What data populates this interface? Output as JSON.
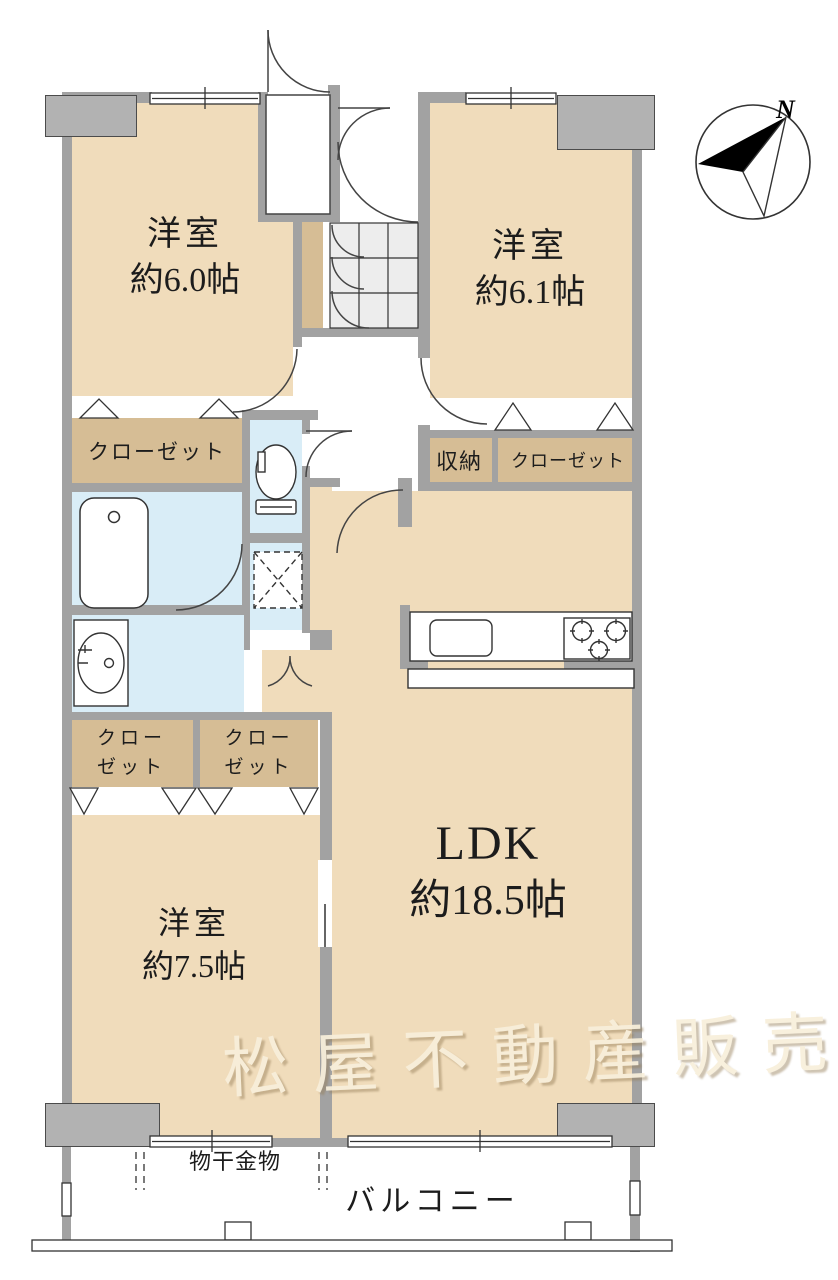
{
  "floorplan": {
    "rooms": {
      "bedroom_nw": {
        "name": "洋室",
        "size": "約6.0帖"
      },
      "bedroom_ne": {
        "name": "洋室",
        "size": "約6.1帖"
      },
      "bedroom_sw": {
        "name": "洋室",
        "size": "約7.5帖"
      },
      "ldk": {
        "name": "LDK",
        "size": "約18.5帖"
      }
    },
    "storage": {
      "closet_nw": "クローゼット",
      "shuno": "収納",
      "closet_ne": "クローゼット",
      "closet_sw_left": {
        "line1": "クロー",
        "line2": "ゼット"
      },
      "closet_sw_right": {
        "line1": "クロー",
        "line2": "ゼット"
      }
    },
    "balcony": {
      "label": "バルコニー",
      "drying_hardware": "物干金物"
    },
    "compass": {
      "north": "N"
    },
    "watermark": "松屋不動産販売",
    "colors": {
      "room_fill": "#f0dcbb",
      "closet_fill": "#d6bd95",
      "water_fill": "#d9edf7",
      "tile_fill": "#ededed",
      "wall": "#a2a2a2",
      "pillar": "#b2b2b2",
      "line": "#333333",
      "watermark_text": "#f8efdb"
    }
  }
}
